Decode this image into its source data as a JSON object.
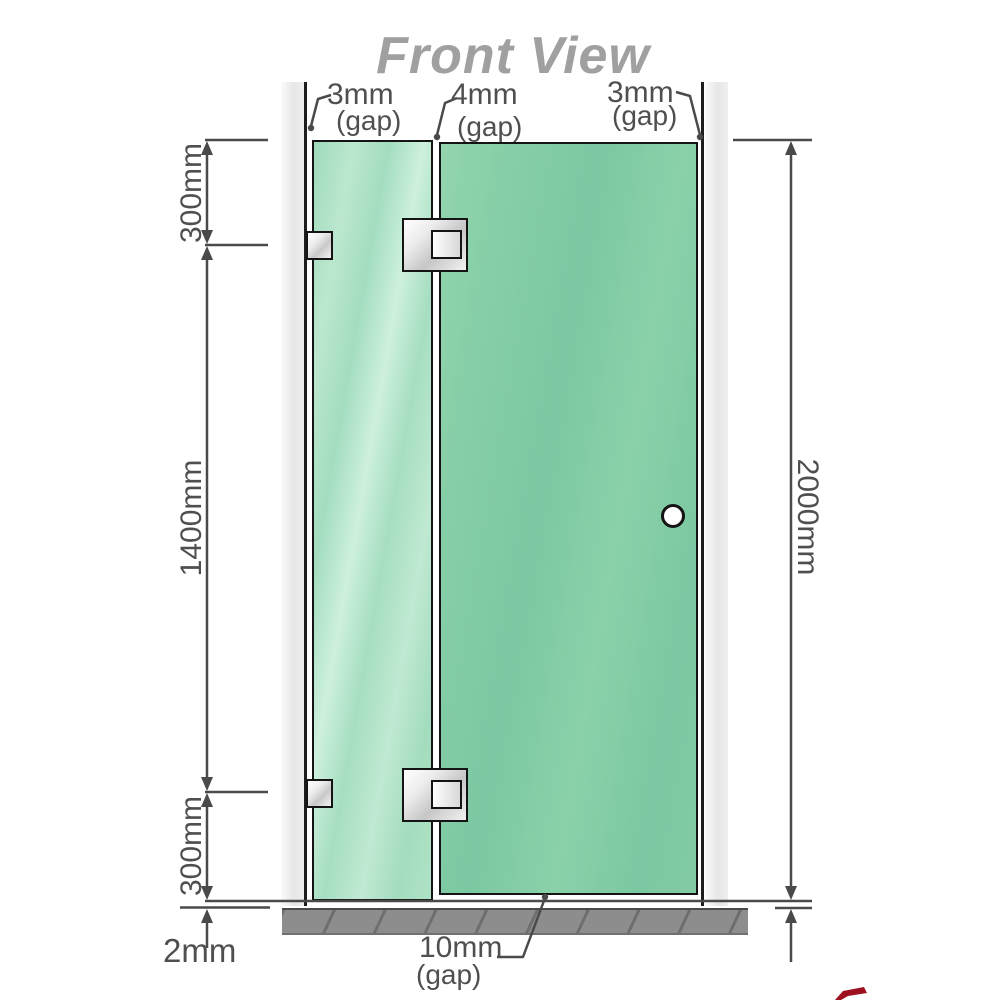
{
  "title": {
    "text": "Front View"
  },
  "labels": {
    "gap_top_left": {
      "value": "3mm",
      "note": "(gap)"
    },
    "gap_top_middle": {
      "value": "4mm",
      "note": "(gap)"
    },
    "gap_top_right": {
      "value": "3mm",
      "note": "(gap)"
    },
    "left_upper": "300mm",
    "left_middle": "1400mm",
    "left_lower": "300mm",
    "bottom_floor_gap": "2mm",
    "gap_bottom_door": {
      "value": "10mm",
      "note": "(gap)"
    },
    "right_total_height": "2000mm"
  },
  "components": {
    "left_wall": "wall-profile",
    "right_wall": "wall-profile",
    "floor": "floor-base",
    "fixed_panel": "fixed-glass-panel",
    "door_panel": "hinged-glass-door",
    "wall_brackets": [
      "top",
      "bottom"
    ],
    "glass_hinges": [
      "top",
      "bottom"
    ],
    "door_knob": "round-knob"
  },
  "colors": {
    "glass_fixed": "#a9dfc2",
    "glass_door": "#7cc8a2",
    "wall": "#e9e9e9",
    "floor": "#8d8d8d",
    "dimension_lines": "#4a4a4a",
    "dimension_text": "#4f4f4f",
    "title_text": "#a0a0a0",
    "watermark_red": "#9e1020"
  }
}
